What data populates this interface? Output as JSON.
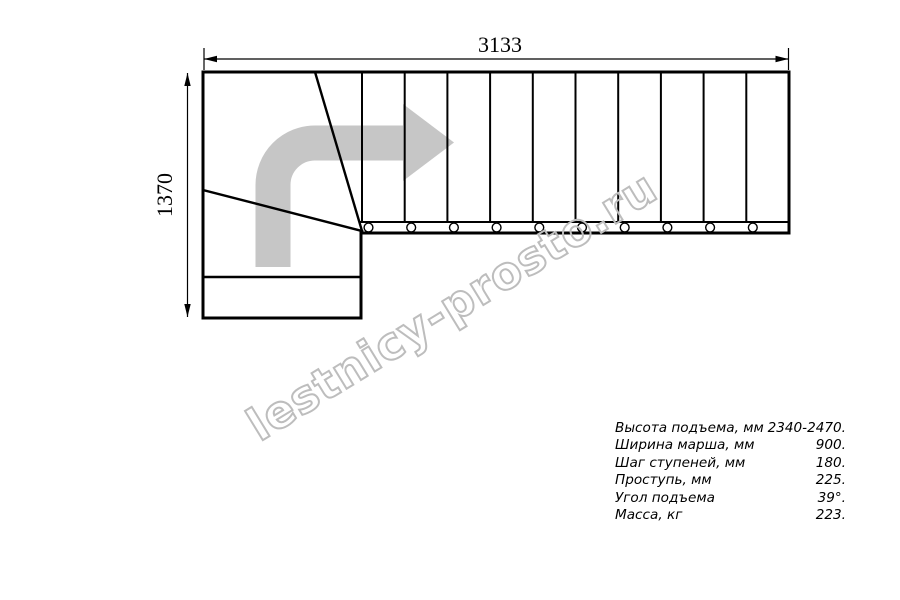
{
  "drawing": {
    "title_hint": "staircase-plan",
    "dim_width_label": "3133",
    "dim_height_label": "1370"
  },
  "watermark": {
    "text": "lestnicy-prosto.ru"
  },
  "specs": {
    "rows": [
      {
        "label": "Высота подъема, мм",
        "value": "2340-2470."
      },
      {
        "label": "Ширина марша, мм",
        "value": "900."
      },
      {
        "label": "Шаг ступеней, мм",
        "value": "180."
      },
      {
        "label": "Проступь, мм",
        "value": "225."
      },
      {
        "label": "Угол подъема",
        "value": "39°."
      },
      {
        "label": "Масса, кг",
        "value": "223."
      }
    ]
  },
  "colors": {
    "line_black": "#000000",
    "arrow_gray": "#c6c6c6",
    "watermark_gray": "#bdbdbd"
  }
}
